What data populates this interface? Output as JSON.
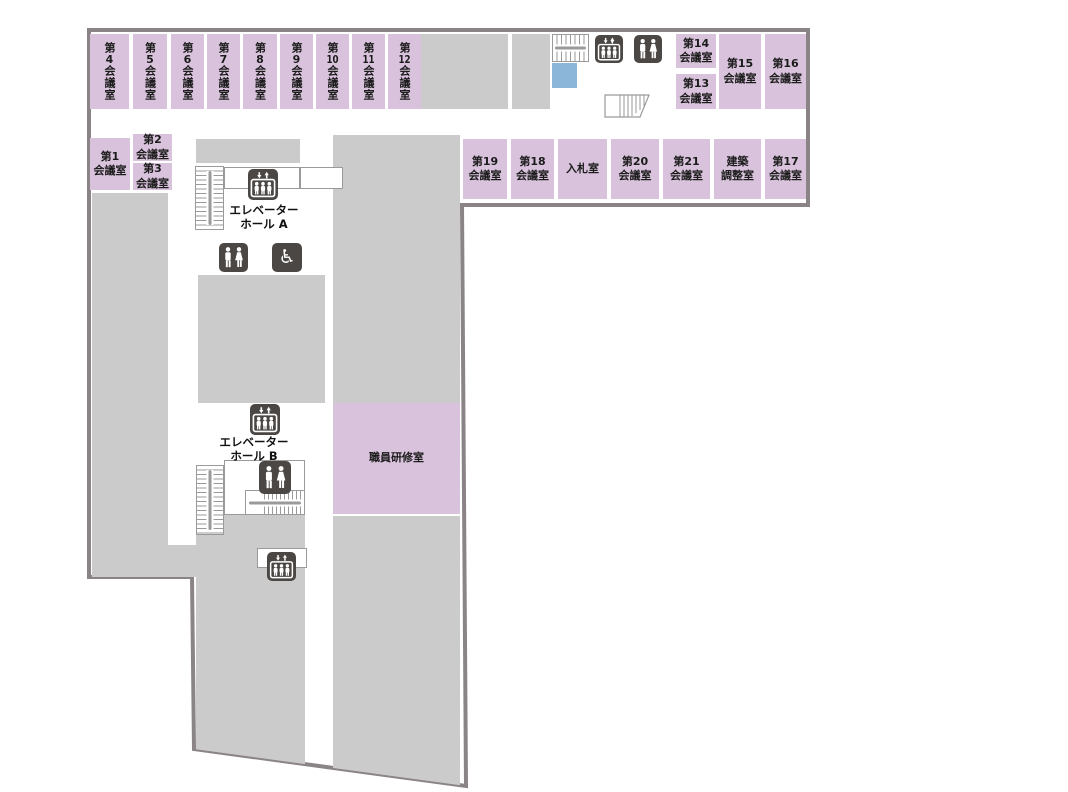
{
  "title": "floor-map",
  "colors": {
    "room": "#d9c3dc",
    "area": "#cbcbcb",
    "wall": "#8b8487",
    "icon": "#4b4744",
    "water": "#8cb5da",
    "line": "#9a9a9a"
  },
  "rooms": {
    "top_row": [
      {
        "pre": "第",
        "num": "4",
        "suf": "会議室"
      },
      {
        "pre": "第",
        "num": "5",
        "suf": "会議室"
      },
      {
        "pre": "第",
        "num": "6",
        "suf": "会議室"
      },
      {
        "pre": "第",
        "num": "7",
        "suf": "会議室"
      },
      {
        "pre": "第",
        "num": "8",
        "suf": "会議室"
      },
      {
        "pre": "第",
        "num": "9",
        "suf": "会議室"
      },
      {
        "pre": "第",
        "num": "10",
        "suf": "会議室"
      },
      {
        "pre": "第",
        "num": "11",
        "suf": "会議室"
      },
      {
        "pre": "第",
        "num": "12",
        "suf": "会議室"
      }
    ],
    "top_right": [
      {
        "l1": "第14",
        "l2": "会議室"
      },
      {
        "l1": "第13",
        "l2": "会議室"
      },
      {
        "l1": "第15",
        "l2": "会議室"
      },
      {
        "l1": "第16",
        "l2": "会議室"
      }
    ],
    "left": [
      {
        "l1": "第1",
        "l2": "会議室"
      },
      {
        "l1": "第2",
        "l2": "会議室"
      },
      {
        "l1": "第3",
        "l2": "会議室"
      }
    ],
    "second_row": [
      {
        "l1": "第19",
        "l2": "会議室"
      },
      {
        "l1": "第18",
        "l2": "会議室"
      },
      {
        "l1": "入札室"
      },
      {
        "l1": "第20",
        "l2": "会議室"
      },
      {
        "l1": "第21",
        "l2": "会議室"
      },
      {
        "l1": "建築",
        "l2": "調整室"
      },
      {
        "l1": "第17",
        "l2": "会議室"
      }
    ],
    "training_room": {
      "l1": "職員研修室"
    }
  },
  "halls": {
    "a": {
      "l1": "エレベーター",
      "l2": "ホール A"
    },
    "b": {
      "l1": "エレベーター",
      "l2": "ホール B"
    }
  },
  "icons": {
    "elevator": "elevator-icon",
    "restroom": "restroom-icon",
    "wheelchair": "wheelchair-icon",
    "wheelchair_glyph": "♿",
    "stairs": "stairs-icon",
    "escalator": "escalator-icon"
  }
}
